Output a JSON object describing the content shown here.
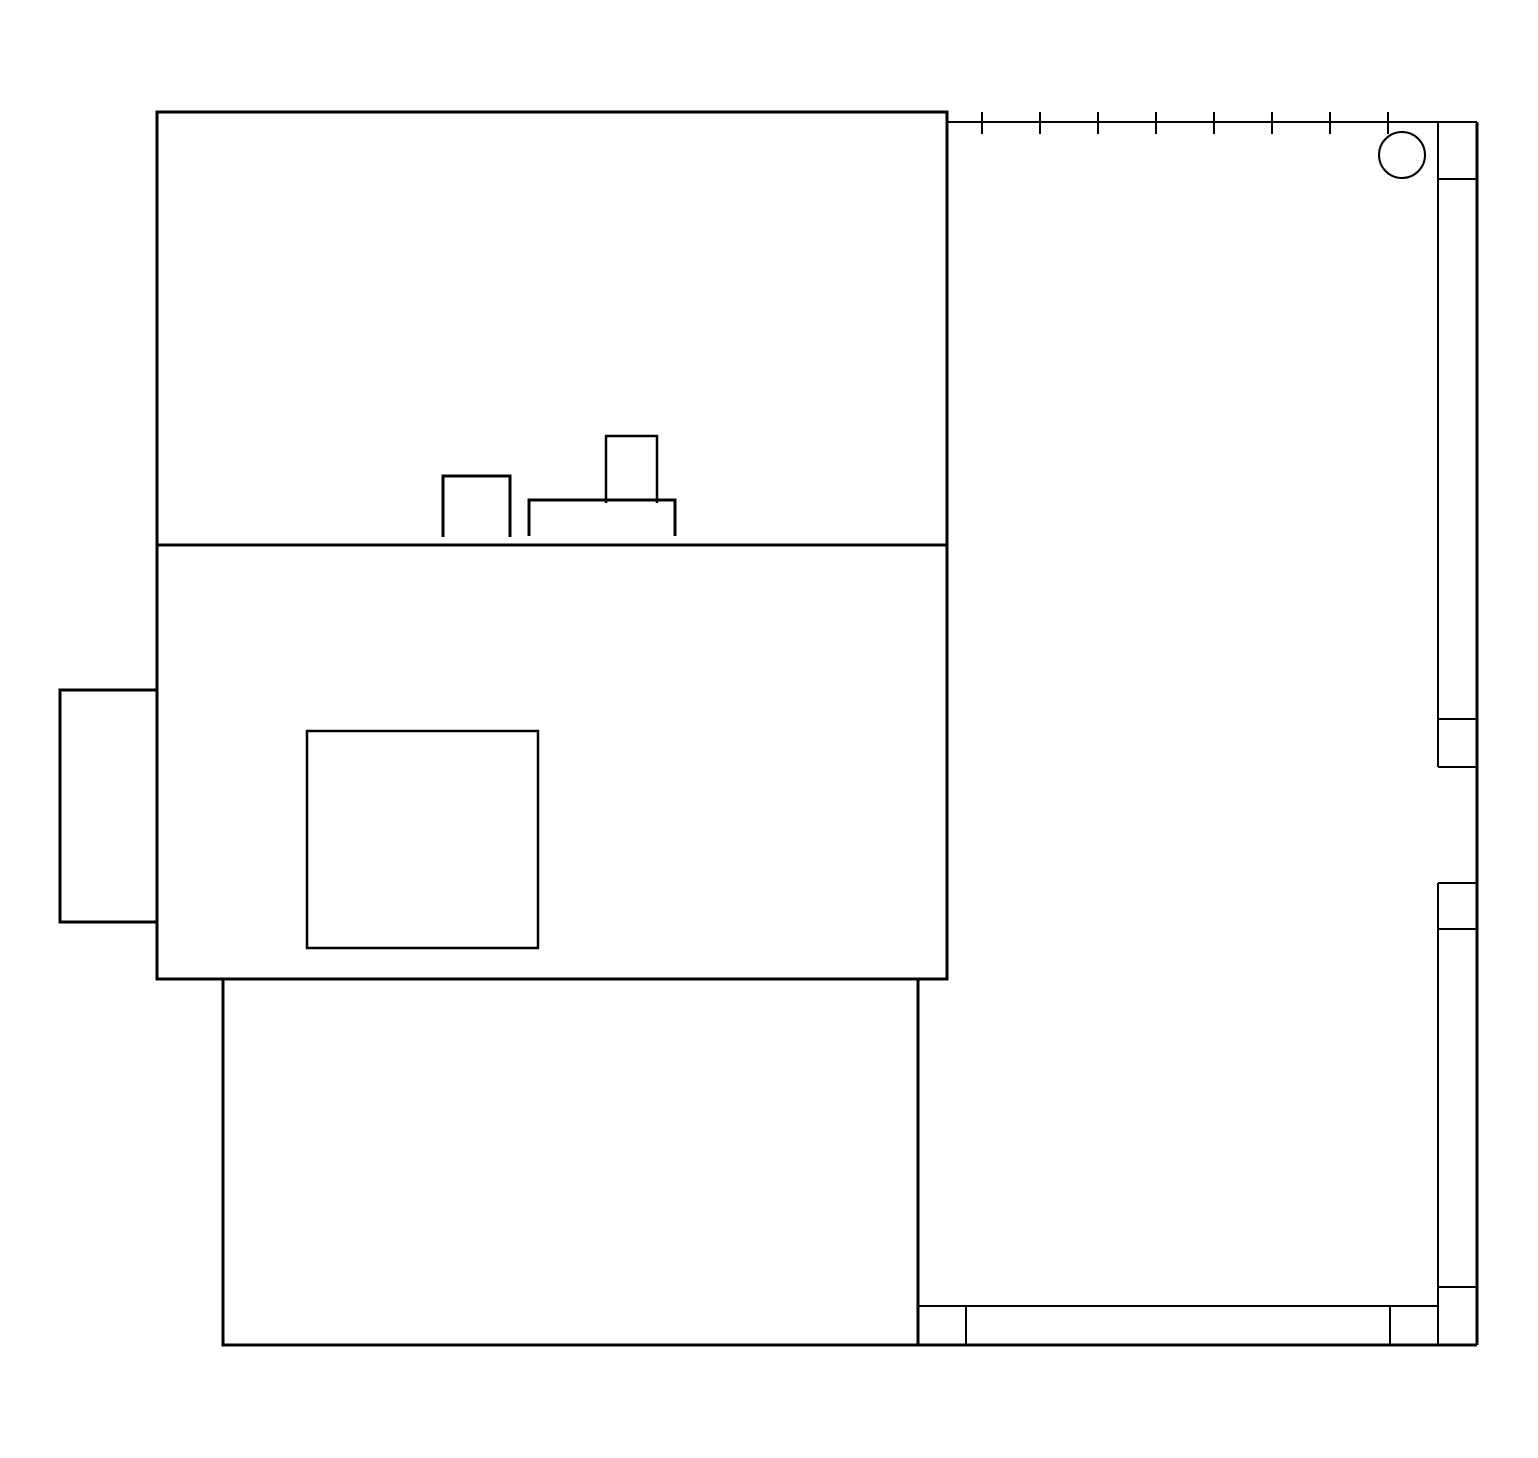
{
  "meta": {
    "description": "floor-plan-line-drawing",
    "canvas": {
      "width": 1538,
      "height": 1458
    },
    "colors": {
      "stroke": "#000000",
      "background": "#ffffff"
    }
  },
  "shapes": [
    {
      "name": "upper-room-outline",
      "type": "rect",
      "x": 157,
      "y": 112,
      "w": 790,
      "h": 433,
      "stroke_width": 3
    },
    {
      "name": "middle-room-outline",
      "type": "rect",
      "x": 157,
      "y": 545,
      "w": 790,
      "h": 434,
      "stroke_width": 3
    },
    {
      "name": "lower-room-outline",
      "type": "rect",
      "x": 223,
      "y": 979,
      "w": 695,
      "h": 366,
      "stroke_width": 3
    },
    {
      "name": "left-bay-outline",
      "type": "rect",
      "x": 60,
      "y": 690,
      "w": 97,
      "h": 232,
      "stroke_width": 3
    },
    {
      "name": "inner-square-outline",
      "type": "rect",
      "x": 307,
      "y": 731,
      "w": 231,
      "h": 217,
      "stroke_width": 2.5
    },
    {
      "name": "bump-small-outline",
      "type": "path",
      "d": "M 443 537 L 443 476 L 510 476 L 510 537",
      "stroke_width": 3
    },
    {
      "name": "bump-wide-outline",
      "type": "path",
      "d": "M 529 536 L 529 500 L 675 500 L 675 536",
      "stroke_width": 3
    },
    {
      "name": "bump-tall-outline",
      "type": "path",
      "d": "M 606 503 L 606 436 L 657 436 L 657 503",
      "stroke_width": 2.5
    },
    {
      "name": "railing-line",
      "type": "line",
      "x1": 948,
      "y1": 122,
      "x2": 1477,
      "y2": 122,
      "stroke_width": 2
    },
    {
      "name": "railing-tick-1",
      "type": "line",
      "x1": 982,
      "y1": 112,
      "x2": 982,
      "y2": 134,
      "stroke_width": 2
    },
    {
      "name": "railing-tick-2",
      "type": "line",
      "x1": 1040,
      "y1": 112,
      "x2": 1040,
      "y2": 134,
      "stroke_width": 2
    },
    {
      "name": "railing-tick-3",
      "type": "line",
      "x1": 1098,
      "y1": 112,
      "x2": 1098,
      "y2": 134,
      "stroke_width": 2
    },
    {
      "name": "railing-tick-4",
      "type": "line",
      "x1": 1156,
      "y1": 112,
      "x2": 1156,
      "y2": 134,
      "stroke_width": 2
    },
    {
      "name": "railing-tick-5",
      "type": "line",
      "x1": 1214,
      "y1": 112,
      "x2": 1214,
      "y2": 134,
      "stroke_width": 2
    },
    {
      "name": "railing-tick-6",
      "type": "line",
      "x1": 1272,
      "y1": 112,
      "x2": 1272,
      "y2": 134,
      "stroke_width": 2
    },
    {
      "name": "railing-tick-7",
      "type": "line",
      "x1": 1330,
      "y1": 112,
      "x2": 1330,
      "y2": 134,
      "stroke_width": 2
    },
    {
      "name": "railing-tick-8",
      "type": "line",
      "x1": 1388,
      "y1": 112,
      "x2": 1388,
      "y2": 134,
      "stroke_width": 2
    },
    {
      "name": "column-circle",
      "type": "circle",
      "cx": 1402,
      "cy": 155,
      "r": 23,
      "stroke_width": 2
    },
    {
      "name": "right-wall-outer-edge",
      "type": "line",
      "x1": 1477,
      "y1": 122,
      "x2": 1477,
      "y2": 1345,
      "stroke_width": 3
    },
    {
      "name": "right-wall-inner-upper",
      "type": "line",
      "x1": 1438,
      "y1": 122,
      "x2": 1438,
      "y2": 767,
      "stroke_width": 2
    },
    {
      "name": "right-wall-inner-lower",
      "type": "line",
      "x1": 1438,
      "y1": 883,
      "x2": 1438,
      "y2": 1345,
      "stroke_width": 2
    },
    {
      "name": "right-wall-divider-1",
      "type": "line",
      "x1": 1438,
      "y1": 179,
      "x2": 1477,
      "y2": 179,
      "stroke_width": 2
    },
    {
      "name": "right-wall-divider-2",
      "type": "line",
      "x1": 1438,
      "y1": 719,
      "x2": 1477,
      "y2": 719,
      "stroke_width": 2
    },
    {
      "name": "right-wall-divider-3",
      "type": "line",
      "x1": 1438,
      "y1": 767,
      "x2": 1477,
      "y2": 767,
      "stroke_width": 2
    },
    {
      "name": "right-wall-divider-4",
      "type": "line",
      "x1": 1438,
      "y1": 883,
      "x2": 1477,
      "y2": 883,
      "stroke_width": 2
    },
    {
      "name": "right-wall-divider-5",
      "type": "line",
      "x1": 1438,
      "y1": 929,
      "x2": 1477,
      "y2": 929,
      "stroke_width": 2
    },
    {
      "name": "right-wall-divider-6",
      "type": "line",
      "x1": 1438,
      "y1": 1287,
      "x2": 1477,
      "y2": 1287,
      "stroke_width": 2
    },
    {
      "name": "bottom-wall-top-edge",
      "type": "line",
      "x1": 918,
      "y1": 1306,
      "x2": 1438,
      "y2": 1306,
      "stroke_width": 2
    },
    {
      "name": "bottom-wall-bottom-edge",
      "type": "line",
      "x1": 918,
      "y1": 1345,
      "x2": 1477,
      "y2": 1345,
      "stroke_width": 3
    },
    {
      "name": "bottom-wall-divider-left",
      "type": "line",
      "x1": 966,
      "y1": 1306,
      "x2": 966,
      "y2": 1345,
      "stroke_width": 2
    },
    {
      "name": "bottom-wall-divider-right",
      "type": "line",
      "x1": 1390,
      "y1": 1306,
      "x2": 1390,
      "y2": 1345,
      "stroke_width": 2
    }
  ]
}
